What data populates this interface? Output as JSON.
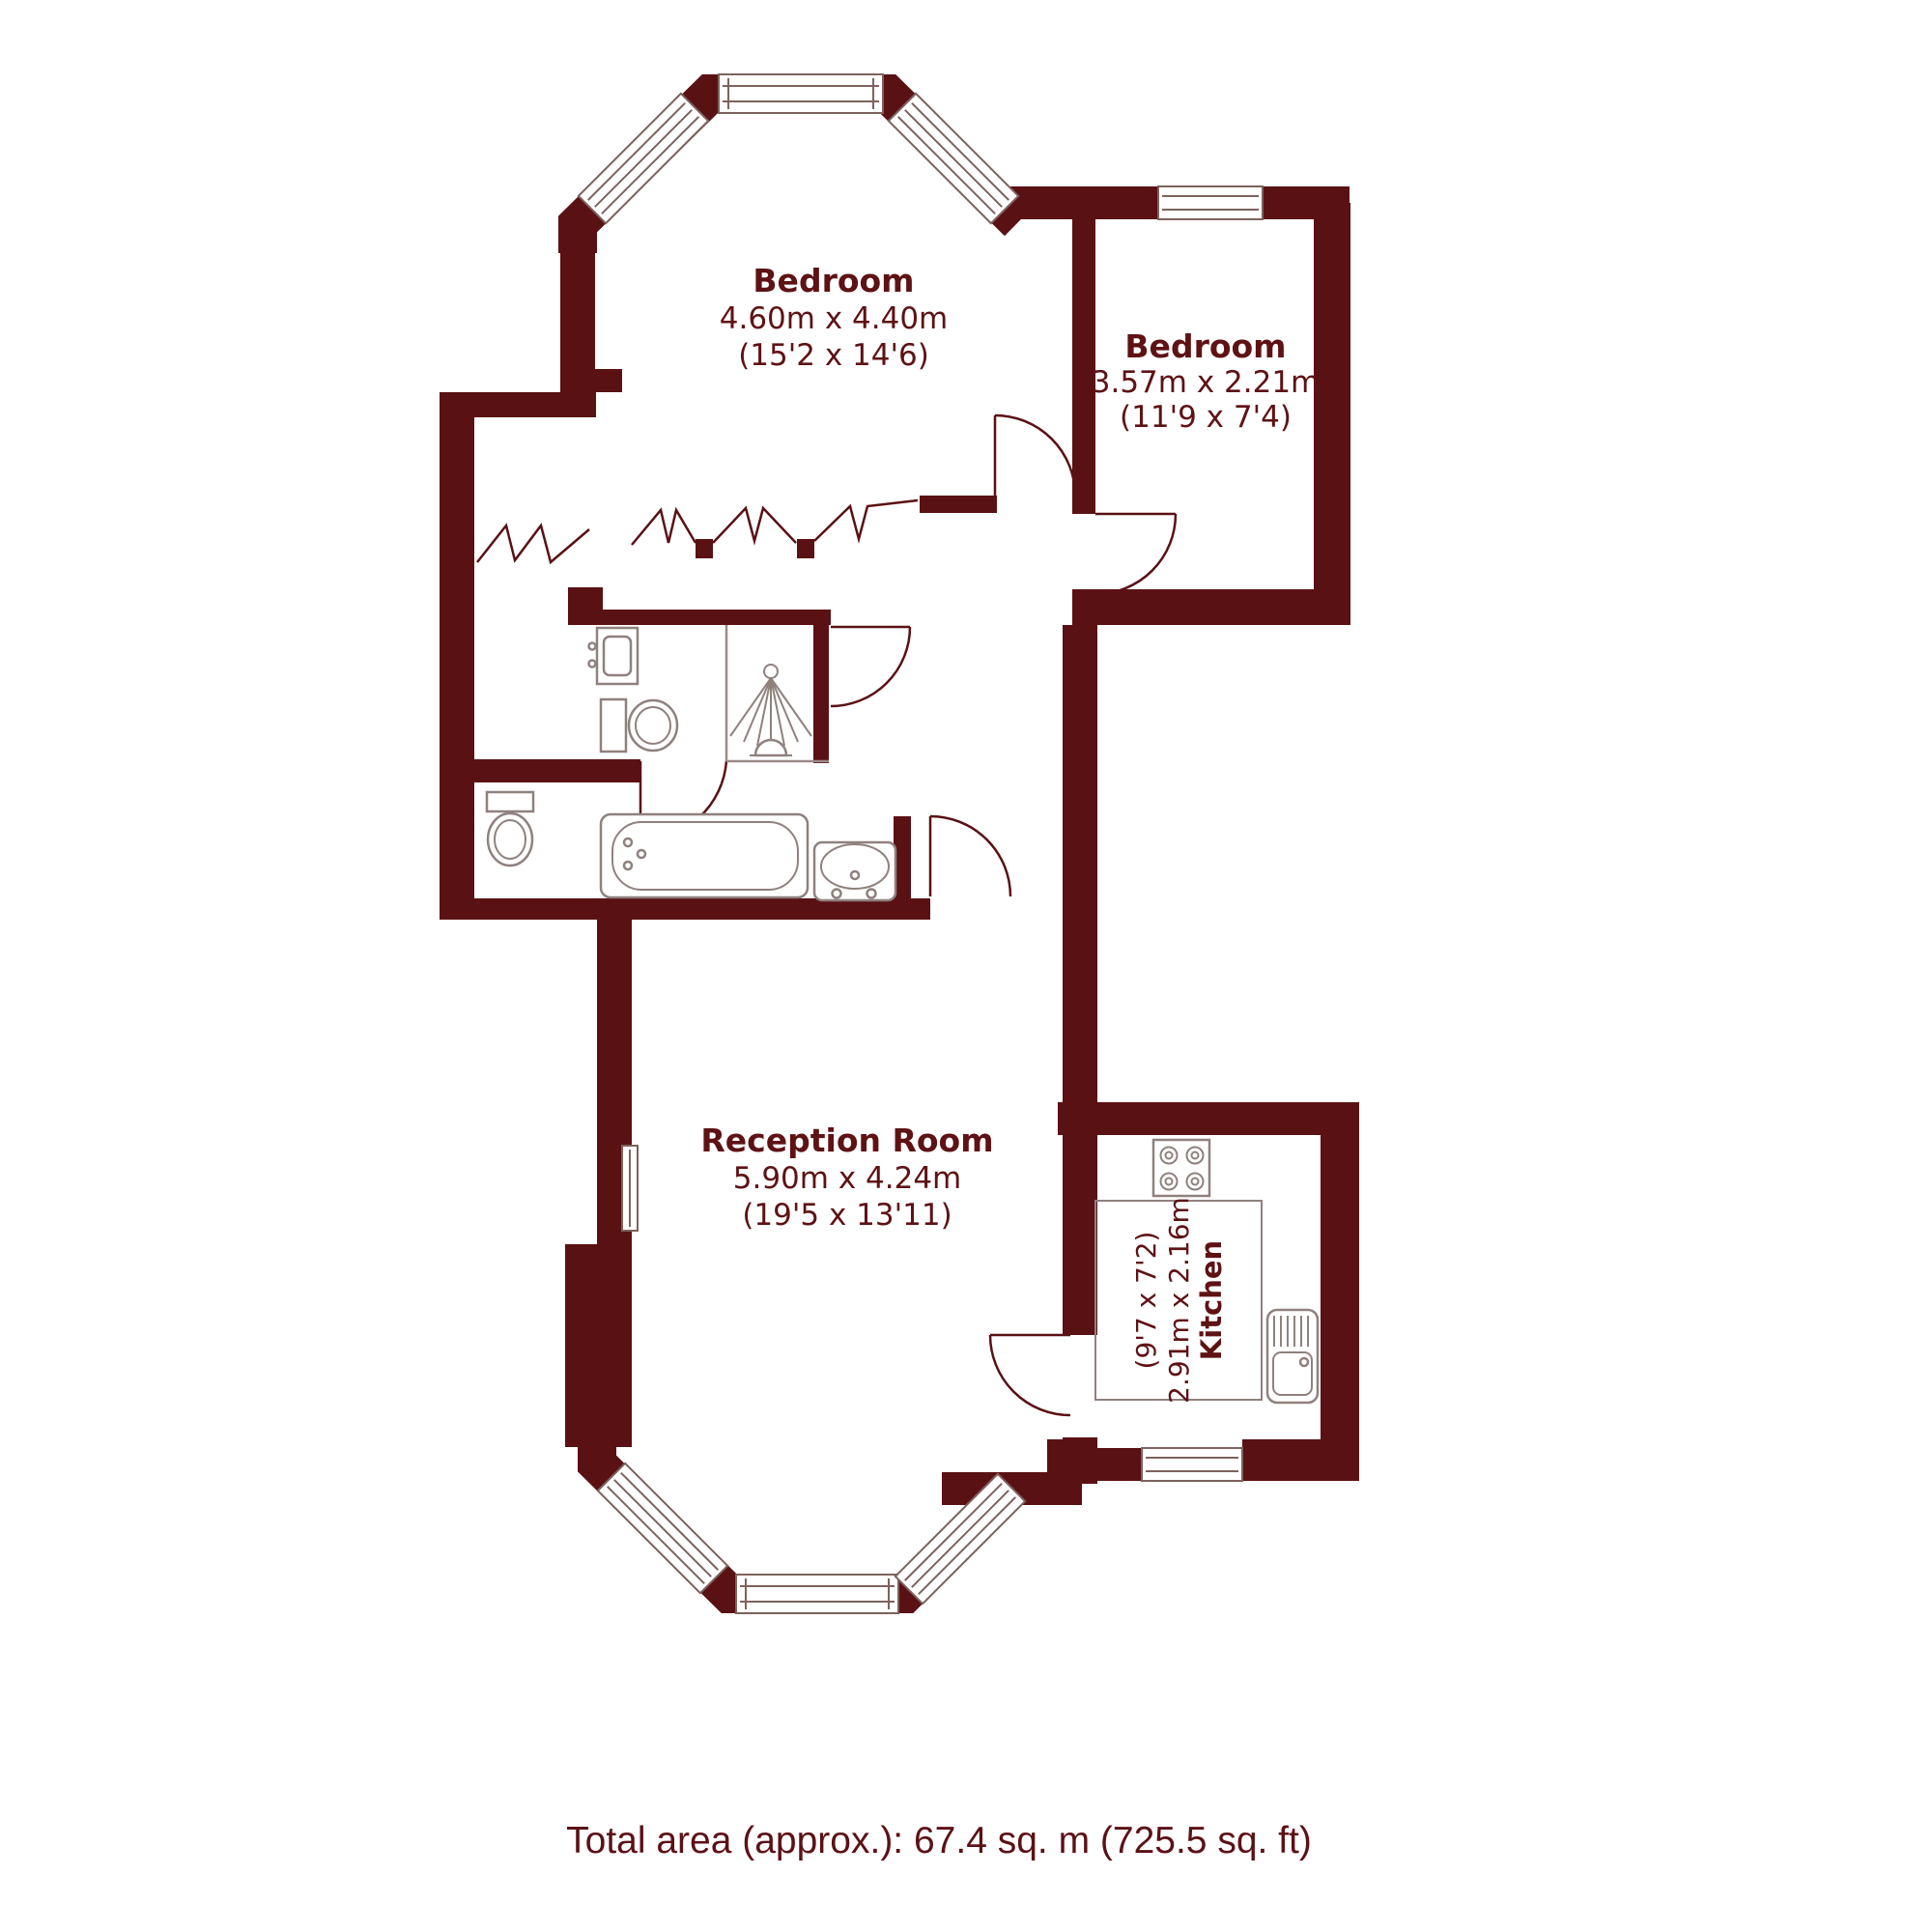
{
  "plan": {
    "rooms": [
      {
        "id": "bedroom-1",
        "name": "Bedroom",
        "metric": "4.60m x 4.40m",
        "imperial": "(15'2 x 14'6)"
      },
      {
        "id": "bedroom-2",
        "name": "Bedroom",
        "metric": "3.57m x 2.21m",
        "imperial": "(11'9 x 7'4)"
      },
      {
        "id": "reception-room",
        "name": "Reception Room",
        "metric": "5.90m x 4.24m",
        "imperial": "(19'5 x 13'11)"
      },
      {
        "id": "kitchen",
        "name": "Kitchen",
        "metric": "2.91m x 2.16m",
        "imperial": "(9'7 x 7'2)"
      }
    ],
    "footer": {
      "total_area": "Total area (approx.): 67.4 sq. m (725.5 sq. ft)"
    },
    "colors": {
      "wall": "#5a1114",
      "label_text": "#5e1214",
      "fixture_outline": "#8f817e"
    },
    "icons": [
      "toilet-icon",
      "basin-icon",
      "shower-icon",
      "bathtub-icon",
      "pedestal-sink-icon",
      "hob-icon",
      "kitchen-sink-icon",
      "window-icon",
      "door-swing-icon",
      "wardrobe-zigzag-icon"
    ]
  }
}
